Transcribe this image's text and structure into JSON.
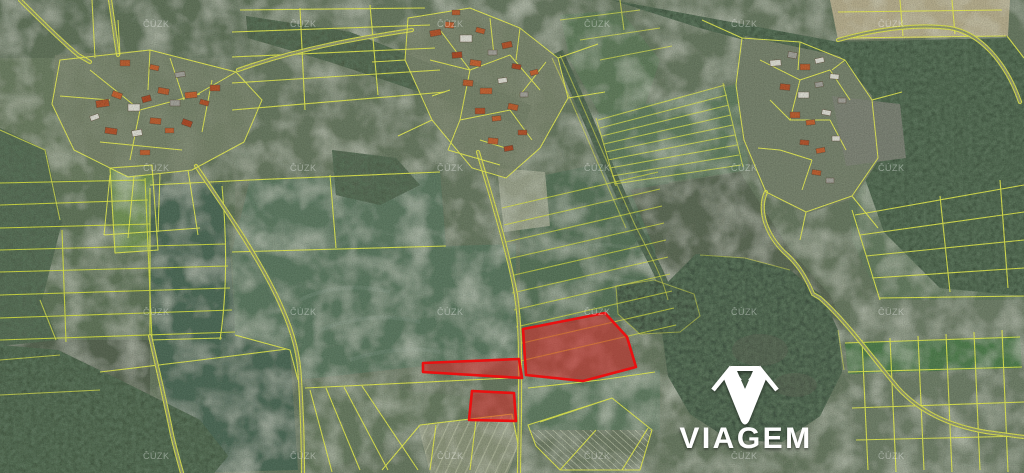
{
  "map": {
    "type": "cadastral-aerial-map",
    "provider_watermark": {
      "text": "ČÚZK",
      "color": "#ffffff",
      "opacity": 0.35,
      "grid_x": [
        143,
        290,
        437,
        584,
        731,
        878
      ],
      "grid_y": [
        23,
        167,
        311,
        455
      ]
    },
    "brand": {
      "name": "VIAGEM",
      "color": "#ffffff"
    },
    "cadastre_line_color": "#e9ef4c",
    "highlight": {
      "stroke": "#ea1111",
      "fill": "#dc2626",
      "fill_opacity": 0.52,
      "parcels": [
        {
          "id": "parcel-large",
          "points": "523,329 605,313 627,337 636,367 583,381 526,375"
        },
        {
          "id": "parcel-strip",
          "points": "423,363 519,359 522,378 423,372"
        },
        {
          "id": "parcel-small",
          "points": "472,391 514,393 516,421 469,420"
        }
      ]
    }
  }
}
